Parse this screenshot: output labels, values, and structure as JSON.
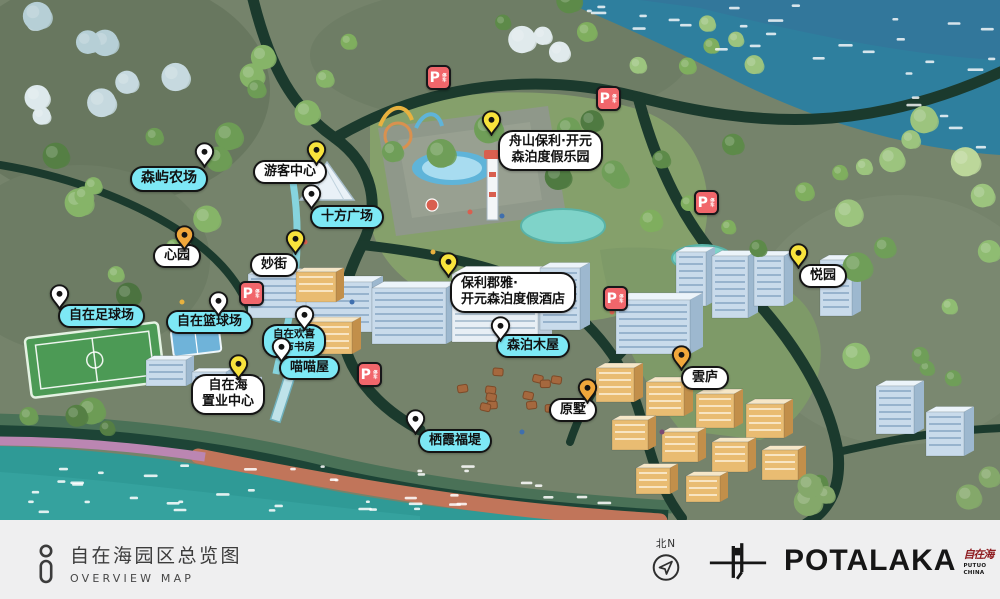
{
  "theme": {
    "label-cyan": "#7de8f5",
    "label-white": "#ffffff",
    "pin-yellow": "#f8e33c",
    "pin-orange": "#f1a73b",
    "pin-white": "#ffffff",
    "parking-red": "#f1666b",
    "sea-teal": "#2f9a96",
    "water-blue": "#2e7f9e",
    "beach-sand": "#c1755a",
    "road-dark": "#1b3a2d",
    "bar-bg": "#efeff0",
    "text-dark": "#3c3c3c",
    "seal-red": "#8f1d21"
  },
  "map": {
    "pois": [
      {
        "id": "senyu-farm",
        "lines": [
          "森屿农场"
        ],
        "style": "cyan",
        "pin": "white",
        "fs": 14,
        "label": {
          "x": 130,
          "y": 166
        },
        "pin_pos": {
          "x": 194,
          "y": 142
        }
      },
      {
        "id": "visitor-center",
        "lines": [
          "游客中心"
        ],
        "style": "light",
        "pin": "yellow",
        "label": {
          "x": 253,
          "y": 160
        },
        "pin_pos": {
          "x": 306,
          "y": 140
        }
      },
      {
        "id": "shifang-plaza",
        "lines": [
          "十方广场"
        ],
        "style": "cyan",
        "pin": "white",
        "label": {
          "x": 310,
          "y": 205
        },
        "pin_pos": {
          "x": 301,
          "y": 184
        }
      },
      {
        "id": "xinyuan",
        "lines": [
          "心园"
        ],
        "style": "light",
        "pin": "orange",
        "label": {
          "x": 153,
          "y": 244
        },
        "pin_pos": {
          "x": 174,
          "y": 225
        }
      },
      {
        "id": "miaojie",
        "lines": [
          "妙街"
        ],
        "style": "light",
        "pin": "yellow",
        "label": {
          "x": 250,
          "y": 253
        },
        "pin_pos": {
          "x": 285,
          "y": 229
        }
      },
      {
        "id": "zhoushan-poly-resort",
        "lines": [
          "舟山保利·开元",
          "森泊度假乐园"
        ],
        "style": "light",
        "pin": "yellow",
        "label": {
          "x": 498,
          "y": 130
        },
        "pin_pos": {
          "x": 481,
          "y": 110
        }
      },
      {
        "id": "poly-junya-hotel",
        "lines": [
          "保利郡雅·",
          "开元森泊度假酒店"
        ],
        "style": "light",
        "pin": "yellow",
        "align": "left",
        "label": {
          "x": 450,
          "y": 272
        },
        "pin_pos": {
          "x": 438,
          "y": 252
        }
      },
      {
        "id": "yueyuan",
        "lines": [
          "悦园"
        ],
        "style": "light",
        "pin": "yellow",
        "label": {
          "x": 799,
          "y": 264
        },
        "pin_pos": {
          "x": 788,
          "y": 243
        }
      },
      {
        "id": "yunlu",
        "lines": [
          "雲庐"
        ],
        "style": "light",
        "pin": "orange",
        "label": {
          "x": 681,
          "y": 366
        },
        "pin_pos": {
          "x": 671,
          "y": 345
        }
      },
      {
        "id": "yuanshu",
        "lines": [
          "原墅"
        ],
        "style": "light",
        "pin": "orange",
        "label": {
          "x": 549,
          "y": 398
        },
        "pin_pos": {
          "x": 577,
          "y": 378
        }
      },
      {
        "id": "zhiye-center",
        "lines": [
          "自在海",
          "置业中心"
        ],
        "style": "light",
        "pin": "yellow",
        "label": {
          "x": 191,
          "y": 374
        },
        "pin_pos": {
          "x": 228,
          "y": 354
        }
      },
      {
        "id": "football-field",
        "lines": [
          "自在足球场"
        ],
        "style": "cyan",
        "pin": "white",
        "label": {
          "x": 58,
          "y": 304
        },
        "pin_pos": {
          "x": 49,
          "y": 284
        }
      },
      {
        "id": "basketball-court",
        "lines": [
          "自在篮球场"
        ],
        "style": "cyan",
        "pin": "white",
        "label": {
          "x": 166,
          "y": 310
        },
        "pin_pos": {
          "x": 208,
          "y": 291
        }
      },
      {
        "id": "city-study",
        "lines": [
          "自在欢喜",
          "城市书房"
        ],
        "style": "cyan",
        "pin": "white",
        "fs": 10.5,
        "label": {
          "x": 262,
          "y": 324
        },
        "pin_pos": {
          "x": 294,
          "y": 305
        }
      },
      {
        "id": "miaomiao-house",
        "lines": [
          "喵喵屋"
        ],
        "style": "cyan",
        "pin": "white",
        "label": {
          "x": 279,
          "y": 356
        },
        "pin_pos": {
          "x": 271,
          "y": 337
        }
      },
      {
        "id": "senpo-cabins",
        "lines": [
          "森泊木屋"
        ],
        "style": "cyan",
        "pin": "white",
        "label": {
          "x": 496,
          "y": 334
        },
        "pin_pos": {
          "x": 490,
          "y": 316
        }
      },
      {
        "id": "qixia-causeway",
        "lines": [
          "栖霞福堤"
        ],
        "style": "cyan",
        "pin": "white",
        "label": {
          "x": 418,
          "y": 429
        },
        "pin_pos": {
          "x": 405,
          "y": 409
        }
      }
    ],
    "parking": {
      "label": "P",
      "sub": "停车",
      "spots": [
        {
          "x": 426,
          "y": 65
        },
        {
          "x": 596,
          "y": 86
        },
        {
          "x": 694,
          "y": 190
        },
        {
          "x": 239,
          "y": 281
        },
        {
          "x": 603,
          "y": 286
        },
        {
          "x": 357,
          "y": 362
        }
      ]
    }
  },
  "footer": {
    "title_cn": "自在海园区总览图",
    "title_en": "OVERVIEW MAP",
    "compass": "北N",
    "brand": "POTALAKA",
    "seal": "自在海",
    "seal_sub1": "PUTUO",
    "seal_sub2": "CHINA"
  }
}
